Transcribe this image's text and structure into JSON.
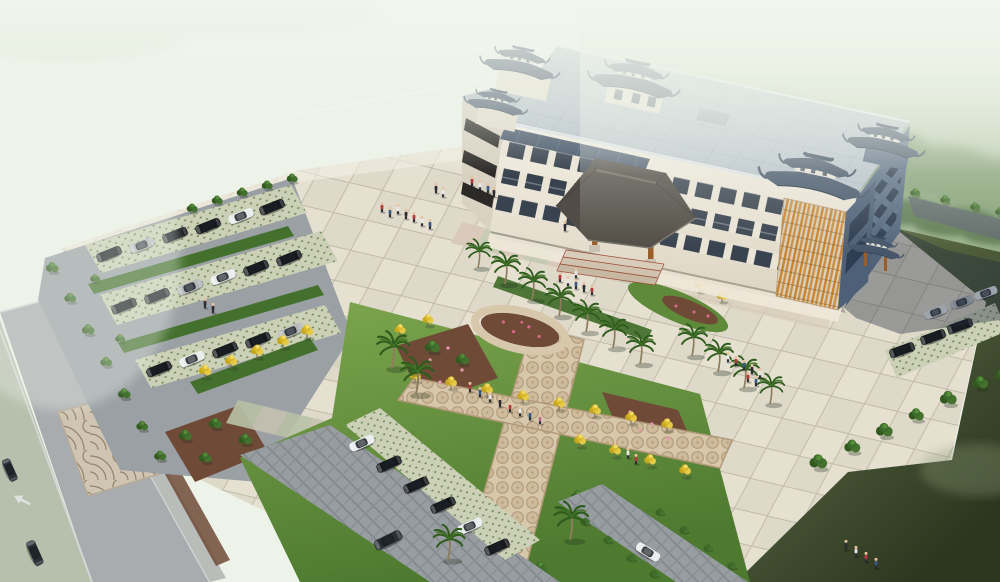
{
  "scene": {
    "type": "architectural-aerial-rendering",
    "subject": "Chinese-style four-storey civic building with traditional blue-tile pavilion roofs, forecourt plaza, landscaped garden and parking lots",
    "setting": "misty pale-green countryside, bird's-eye three-quarter view",
    "building": {
      "storeys": 4,
      "roof_style": "flat panel roof with Chinese hip pavilion roofs and upturned eaves at corners",
      "entrance": "porte-cochere canopy on timber columns with steps",
      "side_entrance": "small canopy on east wing"
    },
    "landscape_features": [
      "checkerboard plaza paving",
      "green lawn insets at entrance",
      "X-shaped mosaic cobble garden paths",
      "flower ring bed",
      "rows of yellow ginkgo trees",
      "palm-lined walkway",
      "grass-grid parking pavers",
      "fan-pattern cobble crossing",
      "perimeter road with lane arrow",
      "hedge and tree screens"
    ],
    "counts": {
      "parked_cars_left_lot": 17,
      "parked_cars_bottom_lot": 6,
      "parked_cars_right_strip": 6,
      "moving_cars": 4,
      "palm_trees": 15,
      "yellow_trees": 21,
      "people_figures": 43
    }
  },
  "palette": {
    "mist": "#eef3ea",
    "forest": "#7d9a6e",
    "fieldMid": "#5f6c4b",
    "fieldDark": "#2c361f",
    "plaza": "#e6e0d1",
    "road": "#a8acae",
    "aisle": "#9aa0a4",
    "pavers": "#cbd0b6",
    "lawn": "#74a048",
    "hedge": "#44702e",
    "mulch": "#6f4a37",
    "pathTan": "#d8c8ab",
    "roofFlat": "#b9c3cb",
    "roofBlue": "#47566a",
    "canopy": "#514d46",
    "wood": "#9a5e2a",
    "wall": "#efe9db",
    "wallShadow": "#5a6c84",
    "window": "#39434f",
    "lattice": "#c8842f",
    "yellowTree": "#d9b92a",
    "palmGreen": "#2f5c1d",
    "carBlack": "#17191d",
    "carWhite": "#e9ebec",
    "carSilver": "#b4b8bb",
    "shadow": "rgba(32,42,62,0.38)"
  }
}
